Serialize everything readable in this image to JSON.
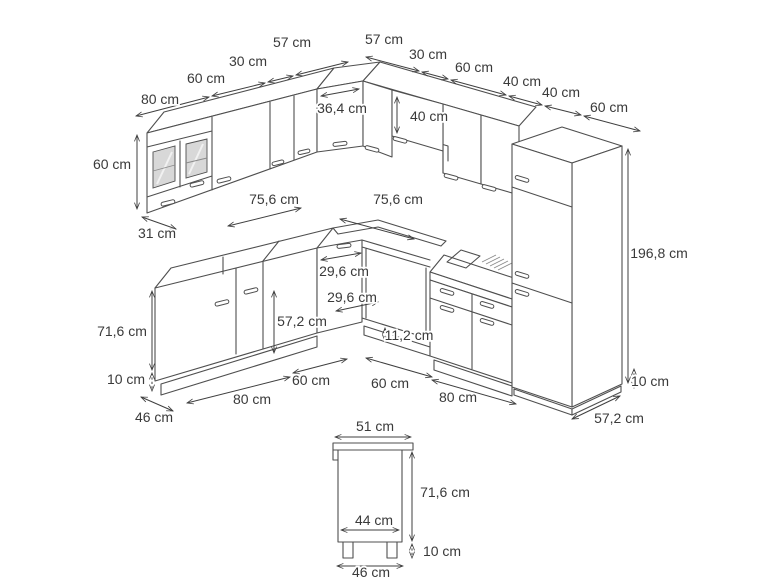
{
  "colors": {
    "background": "#ffffff",
    "line": "#4f4f4f",
    "dimension_line": "#3f3f3f",
    "text": "#3a3a3a",
    "glass_fill": "#d8d8d8"
  },
  "dims": {
    "wall_top_left": [
      "80 cm",
      "60 cm",
      "30 cm",
      "57 cm"
    ],
    "wall_top_right": [
      "57 cm",
      "30 cm",
      "60 cm",
      "40 cm",
      "40 cm",
      "60 cm"
    ],
    "wall_height": "60 cm",
    "wall_depth": "31 cm",
    "corner_wall_width": "36,4 cm",
    "hood_unit_height": "40 cm",
    "worktop_left": "75,6 cm",
    "worktop_right": "75,6 cm",
    "corner_base_door_a": "29,6 cm",
    "corner_base_door_b": "29,6 cm",
    "base_door_height": "57,2 cm",
    "oven_bay_plinth": "11,2 cm",
    "base_height": "71,6 cm",
    "plinth_left": "10 cm",
    "base_depth_left": "46 cm",
    "base_left_widths": [
      "80 cm",
      "60 cm"
    ],
    "base_right_widths": [
      "60 cm",
      "80 cm"
    ],
    "tall_unit_height": "196,8 cm",
    "plinth_right": "10 cm",
    "tall_unit_depth": "57,2 cm",
    "single_cabinet": {
      "top_width": "51 cm",
      "body_height": "71,6 cm",
      "inner_width": "44 cm",
      "feet_height": "10 cm",
      "bottom_depth": "46 cm"
    }
  }
}
